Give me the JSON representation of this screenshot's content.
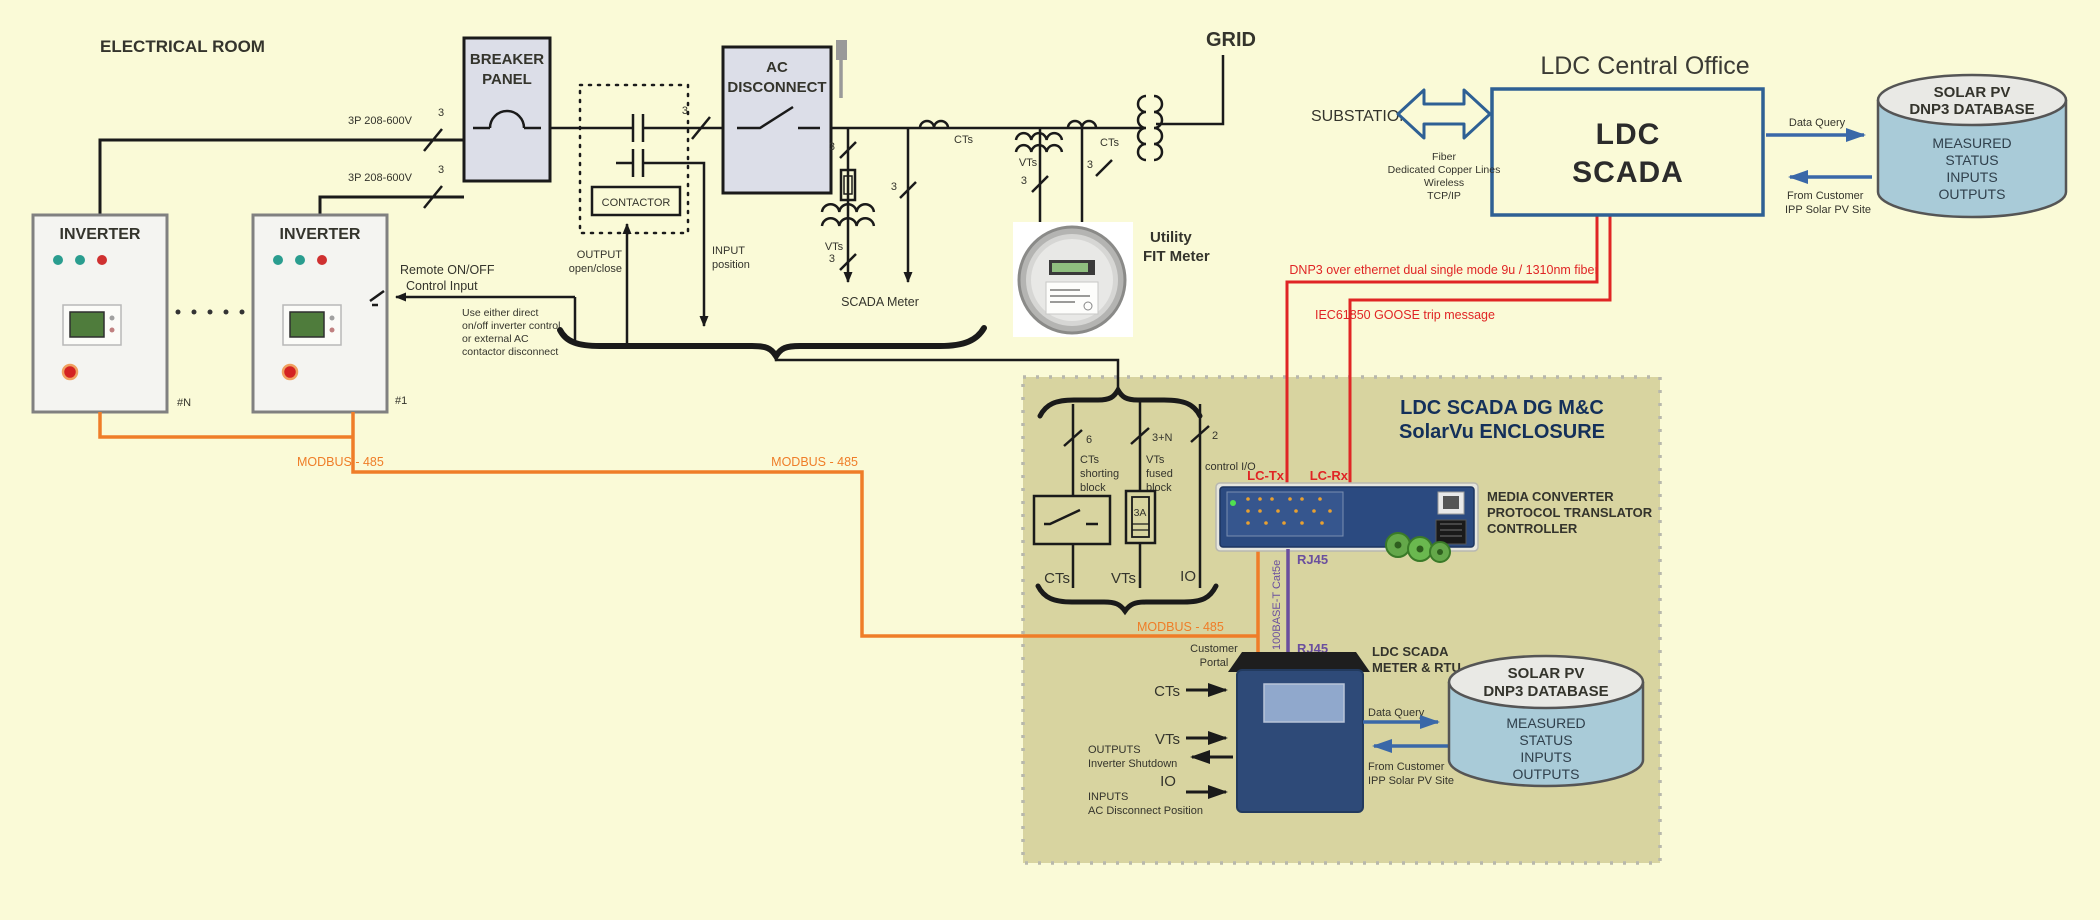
{
  "electrical_room": {
    "title": "ELECTRICAL ROOM",
    "inverter_title": "INVERTER",
    "inverter_n": "#N",
    "inverter_1": "#1",
    "feeder_label": "3P 208-600V",
    "n3": "3",
    "remote_line1": "Remote ON/OFF",
    "remote_line2": "Control Input",
    "note": [
      "Use either direct",
      "on/off inverter control",
      "or external AC",
      "contactor disconnect"
    ],
    "breaker_line1": "BREAKER",
    "breaker_line2": "PANEL",
    "contactor": "CONTACTOR",
    "output_line1": "OUTPUT",
    "output_line2": "open/close",
    "input_line1": "INPUT",
    "input_line2": "position",
    "ac_line1": "AC",
    "ac_line2": "DISCONNECT",
    "vts": "VTs",
    "cts": "CTs",
    "scada_meter": "SCADA Meter",
    "utility_line1": "Utility",
    "utility_line2": "FIT Meter",
    "grid": "GRID"
  },
  "modbus_label": "MODBUS - 485",
  "central_office": {
    "title": "LDC Central Office",
    "substations": "SUBSTATIONS",
    "links": [
      "Fiber",
      "Dedicated Copper Lines",
      "Wireless",
      "TCP/IP"
    ],
    "scada_line1": "LDC",
    "scada_line2": "SCADA",
    "data_query": "Data Query",
    "from_customer_line1": "From Customer",
    "from_customer_line2": "IPP Solar PV Site"
  },
  "database": {
    "title_line1": "SOLAR PV",
    "title_line2": "DNP3 DATABASE",
    "rows": [
      "MEASURED",
      "STATUS",
      "INPUTS",
      "OUTPUTS"
    ]
  },
  "fiber_links": {
    "dnp3": "DNP3 over ethernet dual single mode 9u / 1310nm  fiber",
    "goose": "IEC61850 GOOSE trip message",
    "lc_tx": "LC-Tx",
    "lc_rx": "LC-Rx"
  },
  "enclosure": {
    "title_line1": "LDC SCADA DG M&C",
    "title_line2": "SolarVu ENCLOSURE",
    "qty_cts": "6",
    "qty_vts": "3+N",
    "qty_io": "2",
    "cts_block": [
      "CTs",
      "shorting",
      "block"
    ],
    "vts_block": [
      "VTs",
      "fused",
      "block"
    ],
    "control_io": "control I/O",
    "fuse": "3A",
    "cts": "CTs",
    "vts": "VTs",
    "io": "IO",
    "media_converter": [
      "MEDIA CONVERTER",
      "PROTOCOL TRANSLATOR",
      "CONTROLLER"
    ],
    "rj45": "RJ45",
    "cat5e": "100BASE-T  Cat5e",
    "meter_line1": "LDC SCADA",
    "meter_line2": "METER & RTU",
    "customer_line1": "Customer",
    "customer_line2": "Portal",
    "outputs_line1": "OUTPUTS",
    "outputs_line2": "Inverter Shutdown",
    "io_label": "IO",
    "inputs_line1": "INPUTS",
    "inputs_line2": "AC Disconnect Position",
    "data_query": "Data Query",
    "from_customer_line1": "From Customer",
    "from_customer_line2": "IPP Solar PV Site"
  },
  "colors": {
    "background": "#fafad7",
    "enclosure_khaki": "#d8d4a0",
    "modbus_orange": "#ef7d28",
    "fiber_red": "#e02525",
    "ethernet_purple": "#6a4f9e",
    "scada_box_blue": "#2e6094",
    "arrow_blue": "#3a68a8",
    "device_navy": "#2e4a78",
    "database_blue": "#a9cbd8",
    "panel_gray": "#dcdee8"
  }
}
